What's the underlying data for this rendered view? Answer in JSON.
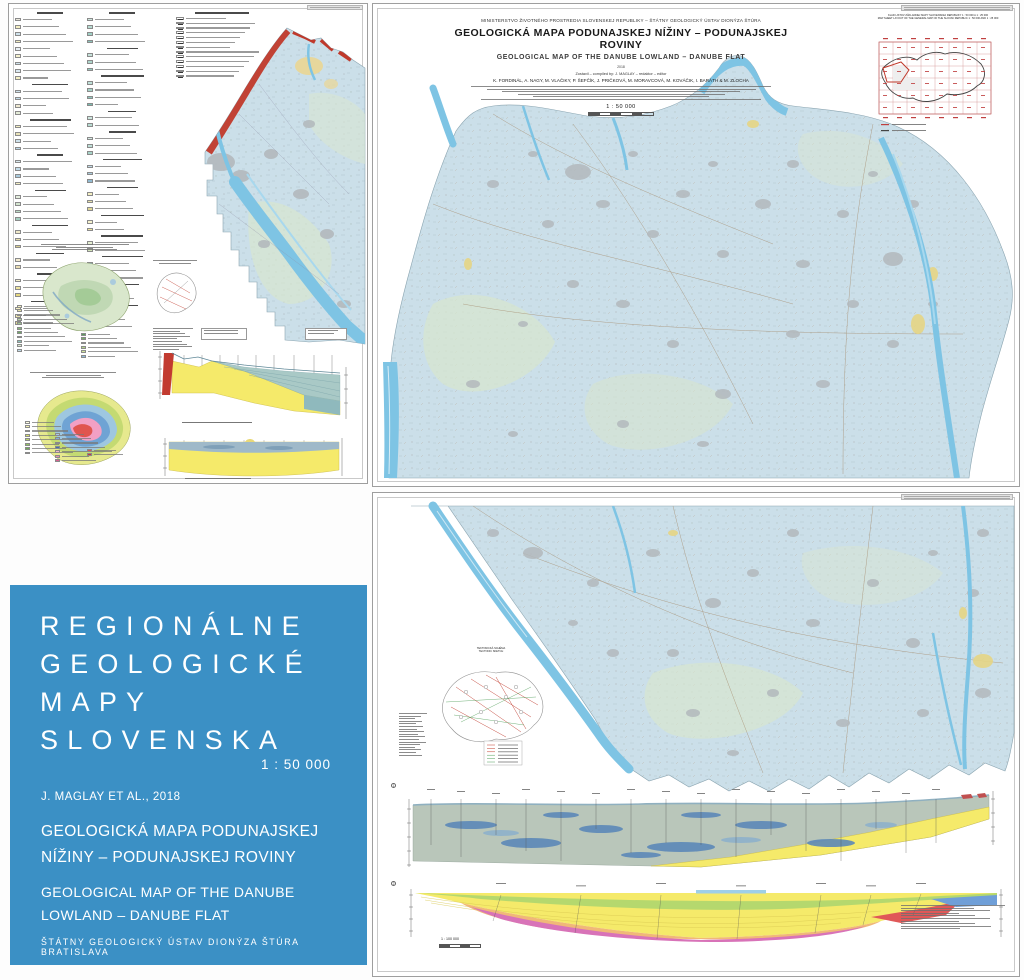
{
  "palette": {
    "cover_blue": "#3b90c5",
    "map_base": "#cbdfe9",
    "water_blue": "#7ec4e4",
    "urban_gray": "#b3b9bd",
    "carpathians_red": "#c0392b",
    "section_yellow": "#f5ea6a",
    "section_teal": "#a9c9c6",
    "section_green": "#b5d86e",
    "section_orange": "#f0b878",
    "section_magenta": "#d873b8",
    "section_red": "#e05858",
    "section_blue": "#6f9fd8"
  },
  "nw_sheet": {
    "legend_col1": [
      "H",
      "#eceadf",
      "#f4efc3",
      "#cfe2ec",
      "#f4efc3",
      "#e9f0f5",
      "#f7f3cf",
      "#cfe2ec",
      "#dce9f1",
      "#f4efc3",
      "H",
      "#cfe2ec",
      "#c2dbe8",
      "#f0ead2",
      "#e4ecd8",
      "H",
      "#f4efc3",
      "#e8e2b8",
      "#cfe2ec",
      "#bcd8e8",
      "H",
      "#d9e8ee",
      "#c2dbe8",
      "#aacbdd",
      "#f4efc3",
      "H",
      "#e4eede",
      "#d3e5cf",
      "#bddcc8",
      "#a5cfc0",
      "H",
      "#efe9c9",
      "#e6dfae",
      "#d8cf92",
      "H",
      "#f2ead0",
      "#e9ddb4",
      "H",
      "#f7f3cf",
      "#efe59f",
      "#e6d87f",
      "H",
      "#f4efc3",
      "#eae3ad",
      "#ded593"
    ],
    "legend_col2": [
      "H",
      "#cfe7df",
      "#b8dcd2",
      "#a0d0c6",
      "#8cc4bb",
      "H",
      "#c6e2da",
      "#aed6cc",
      "#96cabf",
      "H",
      "#bfe0d8",
      "#a7d4c9",
      "#8fc8bd",
      "#77bcb0",
      "H",
      "#cfe7df",
      "#b8dcd2",
      "H",
      "#d7ebe4",
      "#bfe0d8",
      "#a7d4c9",
      "H",
      "#c2dbe8",
      "#aacbdd",
      "#92bbd2",
      "H",
      "#f4efc3",
      "#eae3ad",
      "#e0d797",
      "H",
      "#f7f3cf",
      "#efe59f",
      "H",
      "#e6f0d2",
      "#d4e6b8",
      "H",
      "#8fb8d8",
      "#e07070",
      "#f0a8b8",
      "H",
      "#e0e0e0",
      "#b8cce0",
      "H",
      "#7fbf5f",
      "#f0a050",
      "#e05050"
    ],
    "symbol_rows": 13,
    "inset_quaternary": {
      "group1": [
        "#f5f0c0",
        "#e8e4a8",
        "#cfe3c8",
        "#b5d6a8",
        "#9cc890",
        "#84ba78",
        "#6cab62",
        "#a8d4cc",
        "#8cc4bb",
        "#d9e7cc",
        "#c2dbe8"
      ],
      "group2": [
        "#5a9e5a",
        "#78b068",
        "#96c276",
        "#b4d488",
        "#d2e69a",
        "#8fb8d8"
      ]
    },
    "inset_thickness": {
      "left": [
        "#fdfce3",
        "#f5f2b0",
        "#e9e784",
        "#d9e06a",
        "#b9d468",
        "#8fc35f",
        "#6aae55",
        "#4f9a4a"
      ],
      "right": [
        "#a8c8e8",
        "#7fb2d8",
        "#5b8fc9",
        "#3f6fae",
        "#f2b5cc",
        "#e88aad",
        "#d9608f"
      ],
      "extra": [
        "#e0554f",
        "#c23b3b"
      ]
    }
  },
  "main_sheet": {
    "ministry": "MINISTERSTVO ŽIVOTNÉHO PROSTREDIA SLOVENSKEJ REPUBLIKY – ŠTÁTNY GEOLOGICKÝ ÚSTAV DIONÝZA ŠTÚRA",
    "title_sk": "GEOLOGICKÁ MAPA PODUNAJSKEJ NÍŽINY – PODUNAJSKEJ ROVINY",
    "title_en": "GEOLOGICAL MAP OF THE DANUBE LOWLAND – DANUBE FLAT",
    "year": "2018",
    "compiled_by": "Zostavil – compiled by: J. MAGLAY – redaktor – editor",
    "authors": "K. FORDINÁL, A. NAGY, M. VLAČIKY, P. ŠEFČÍK, J. PRIČKOVÁ, M. MORAVCOVÁ, M. KOVÁČIK, I. BARÁTH & M. ZLOCHA",
    "scale": "1 : 50 000",
    "index_inset": {
      "title_sk": "KLAD LISTOV ZÁKLADNEJ MAPY SLOVENSKEJ REPUBLIKY 1 : 50 000 A 1 : 25 000",
      "title_en": "MAP SHEET LAYOUT OF THE GENERAL MAP OF THE SLOVAK REPUBLIC 1 : 50 000 AND 1 : 25 000"
    }
  },
  "south_sheet": {
    "tectonic_title_sk": "TEKTONICKÁ SCHÉMA",
    "tectonic_title_en": "TECTONIC SKETCH",
    "section_scale": "1 : 100 000"
  },
  "cover": {
    "series_line1": "REGIONÁLNE",
    "series_line2": "GEOLOGICKÉ",
    "series_line3": "MAPY",
    "series_line4": "SLOVENSKA",
    "scale": "1 : 50 000",
    "byline": "J. MAGLAY ET AL., 2018",
    "title_sk_line1": "GEOLOGICKÁ MAPA PODUNAJSKEJ",
    "title_sk_line2": "NÍŽINY – PODUNAJSKEJ ROVINY",
    "title_en_line1": "GEOLOGICAL MAP OF THE DANUBE",
    "title_en_line2": "LOWLAND – DANUBE FLAT",
    "publisher": "ŠTÁTNY GEOLOGICKÝ ÚSTAV DIONÝZA ŠTÚRA BRATISLAVA"
  }
}
